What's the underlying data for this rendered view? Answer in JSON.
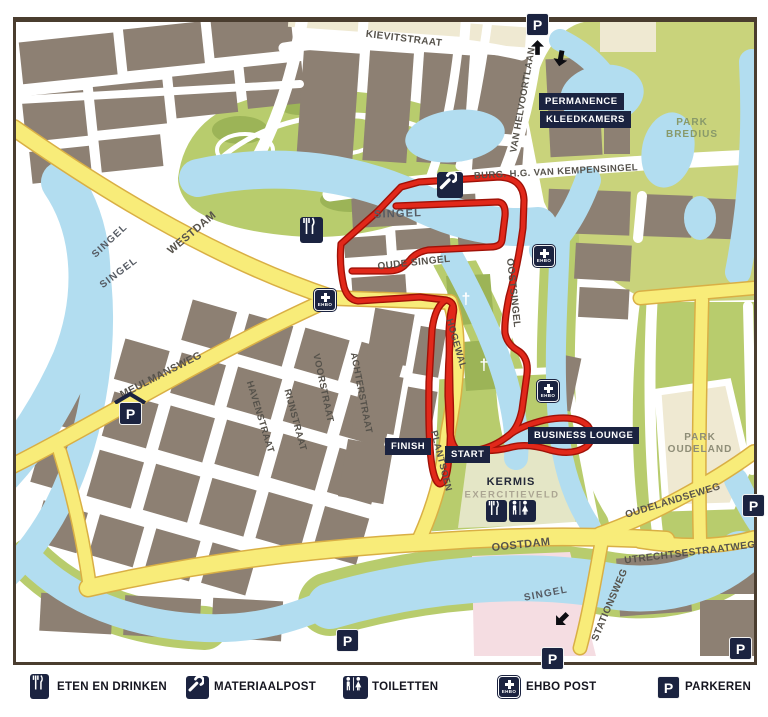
{
  "map": {
    "labels": {
      "kievitstraat": "KIEVITSTRAAT",
      "van_helvoortlaan": "VAN HELVOORTLAAN",
      "kempensingel": "BURG. H.G. VAN KEMPENSINGEL",
      "singel_mid": "SINGEL",
      "westdam": "WESTDAM",
      "singel_left_1": "SINGEL",
      "singel_left_2": "SINGEL",
      "oude_singel": "OUDE SINGEL",
      "oostsingel": "OOSTSINGEL",
      "meulmansweg": "MEULMANSWEG",
      "havenstraat": "HAVENSTRAAT",
      "rijnstraat": "RIJNSTRAAT",
      "voorstraat": "VOORSTRAAT",
      "achterstraat": "ACHTERSTRAAT",
      "hogewal": "HOGEWAL",
      "plantsoen": "PLANTSOEN",
      "oostdam": "OOSTDAM",
      "oudelandseweg": "OUDELANDSEWEG",
      "utrechtsestraatweg": "UTRECHTSESTRAATWEG",
      "stationsweg": "STATIONSWEG",
      "singel_bottom": "SINGEL",
      "park_bredius_line1": "PARK",
      "park_bredius_line2": "BREDIUS",
      "park_oudeland_line1": "PARK",
      "park_oudeland_line2": "OUDELAND",
      "kermis": "KERMIS",
      "exercitieveld": "EXERCITIEVELD"
    },
    "poi": {
      "finish": "FINISH",
      "start": "START",
      "business_lounge": "BUSINESS LOUNGE",
      "permanence": "PERMANENCE",
      "kleedkamers": "KLEEDKAMERS"
    },
    "icons": {
      "parking_letter": "P",
      "ehbo_label": "EHBO",
      "church_cross": "†"
    }
  },
  "legend": {
    "items": [
      {
        "icon": "restaurant-icon",
        "label": "ETEN EN DRINKEN"
      },
      {
        "icon": "wrench-icon",
        "label": "MATERIAALPOST"
      },
      {
        "icon": "toilets-icon",
        "label": "TOILETTEN"
      },
      {
        "icon": "ehbo-icon",
        "label": "EHBO POST"
      },
      {
        "icon": "parking-icon",
        "label": "PARKEREN"
      }
    ]
  },
  "colors": {
    "route_red": "#E1281A",
    "route_casing": "#A01107",
    "water_blue": "#B2DDF0",
    "park_green": "#B8CC6D",
    "road_yellow": "#F8EC79",
    "block_taupe": "#8D8073",
    "navy": "#1B2340"
  }
}
